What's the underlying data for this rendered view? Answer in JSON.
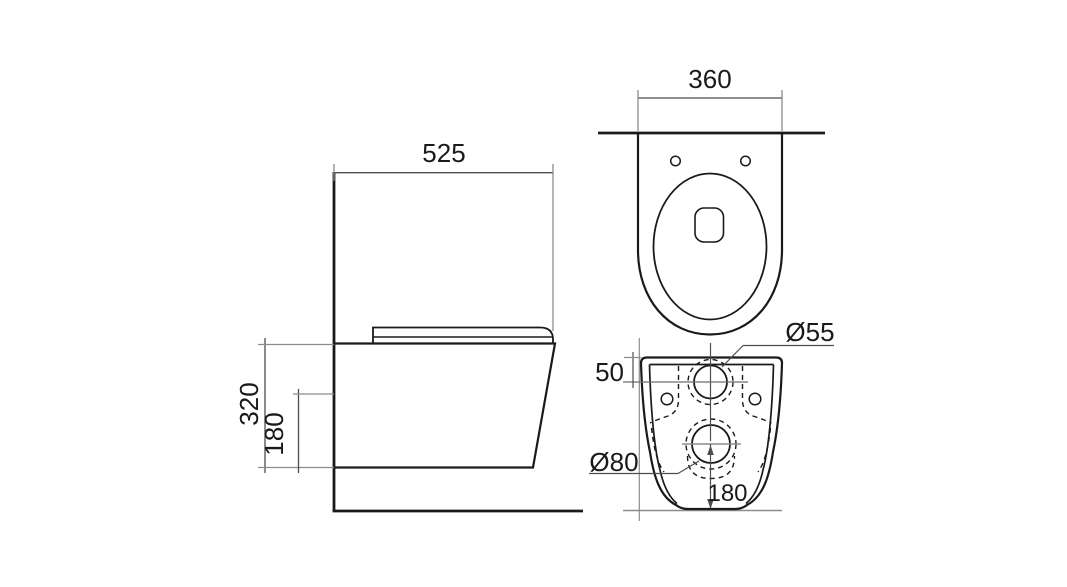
{
  "meta": {
    "description": "Technical dimension drawing of a wall-hung toilet with three orthographic views (side, top, rear)"
  },
  "colors": {
    "background": "#ffffff",
    "object_line": "#1a1a1a",
    "dimension_line": "#4d4d4d",
    "helper_line": "#8c8c8c",
    "text": "#1a1a1a"
  },
  "views": {
    "side": {
      "width": "525",
      "height": "320",
      "drain_height": "180"
    },
    "top": {
      "width": "360"
    },
    "rear": {
      "inlet_offset": "50",
      "inlet_diameter": "Ø55",
      "outlet_diameter": "Ø80",
      "outlet_floor_distance": "180"
    }
  }
}
